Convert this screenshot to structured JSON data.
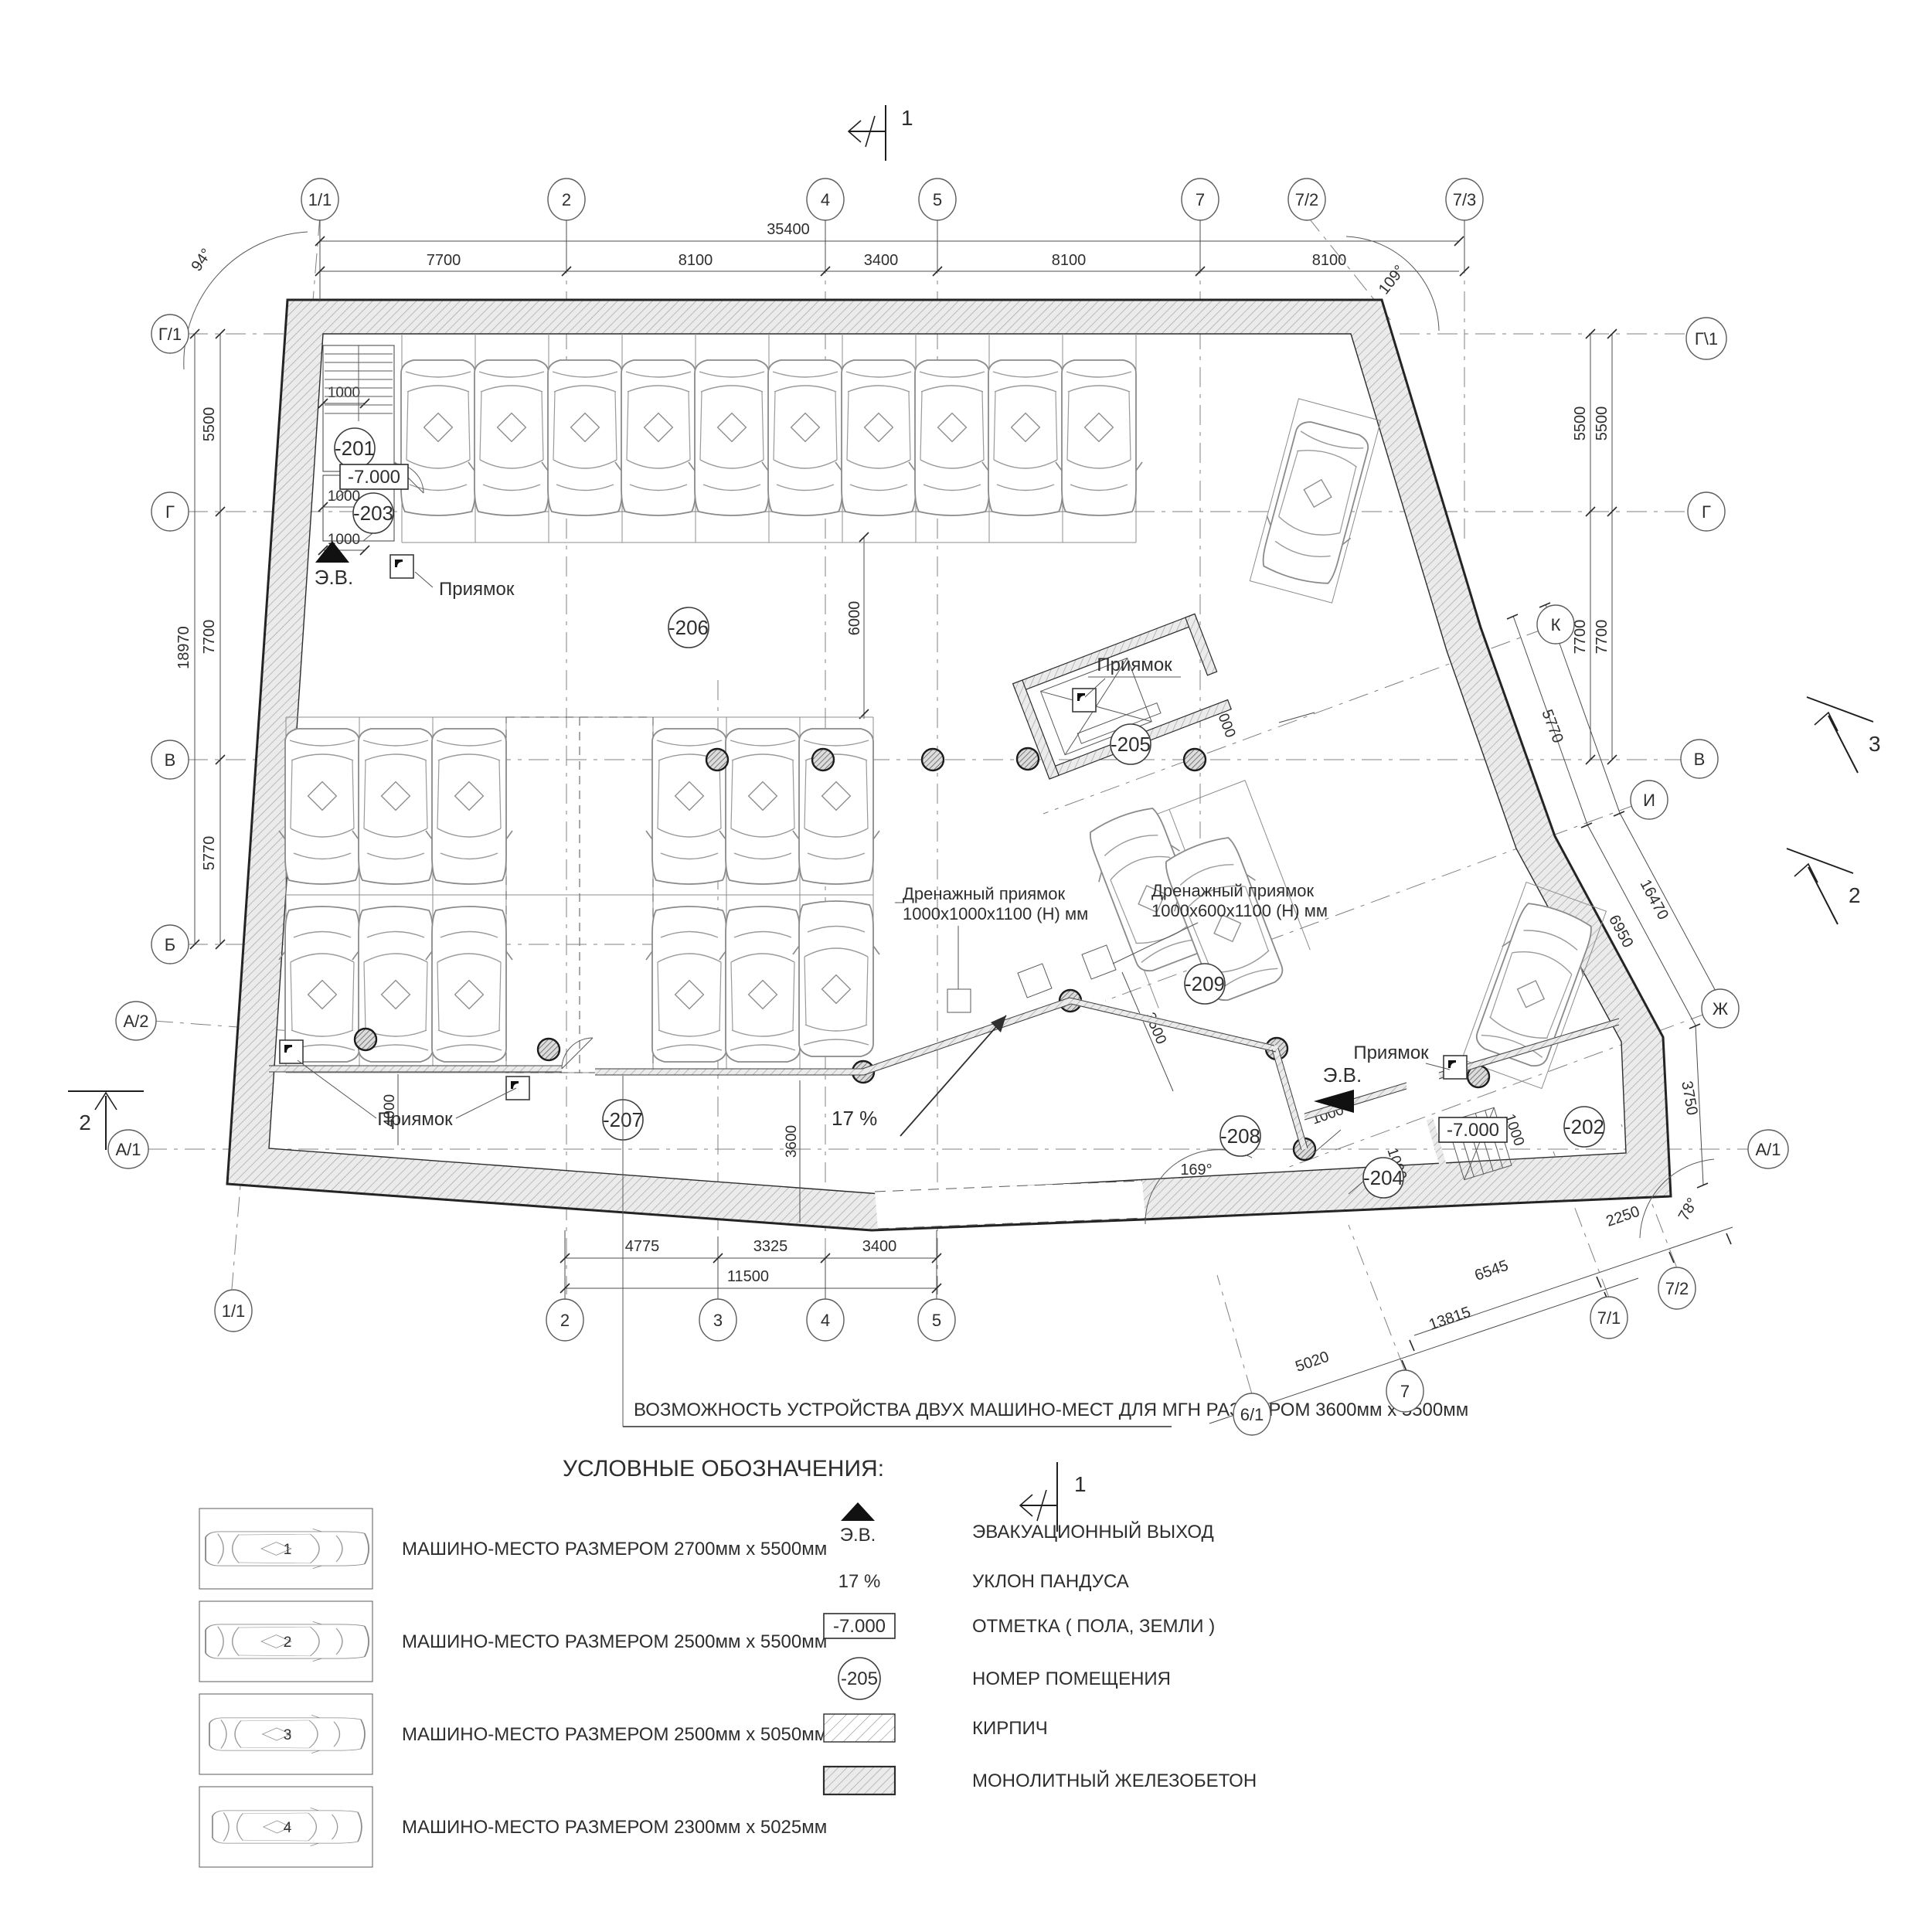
{
  "axes": {
    "top": [
      "1/1",
      "2",
      "4",
      "5",
      "7",
      "7/2",
      "7/3"
    ],
    "bottom": [
      "2",
      "3",
      "4",
      "5"
    ],
    "bottom_left": "1/1",
    "bottom_right": [
      "6/1",
      "7",
      "7/1",
      "7/2"
    ],
    "left": [
      "Г/1",
      "Г",
      "В",
      "Б",
      "А/2",
      "А/1"
    ],
    "right": [
      "Г\\1",
      "Г",
      "К",
      "В",
      "И",
      "Ж",
      "А/1"
    ]
  },
  "dims": {
    "top_total": "35400",
    "top": [
      "7700",
      "8100",
      "3400",
      "8100",
      "8100"
    ],
    "left_total": "18970",
    "left": [
      "5500",
      "7700",
      "5770"
    ],
    "right_v": [
      "5500",
      "5500",
      "7700",
      "7700"
    ],
    "right_diag": [
      "5770",
      "16470",
      "6950",
      "3750"
    ],
    "bottom": [
      "4775",
      "3325",
      "3400"
    ],
    "bottom_total": "11500",
    "bottom_right": [
      "5020",
      "13815",
      "6545",
      "2250"
    ],
    "misc": {
      "st1": "1000",
      "st2": "1000",
      "st3": "1000",
      "w4000": "4000",
      "h6000": "6000",
      "r3600": "3600",
      "r3500": "3500",
      "p1000": "1000",
      "m1": "1000",
      "m2": "1000",
      "m3": "1000"
    },
    "angles": {
      "a94": "94°",
      "a109": "109°",
      "a169": "169°",
      "a78": "78°"
    }
  },
  "rooms": {
    "201": "-201",
    "202": "-202",
    "203": "-203",
    "204": "-204",
    "205": "-205",
    "206": "-206",
    "207": "-207",
    "208": "-208",
    "209": "-209"
  },
  "labels": {
    "pit": "Приямок",
    "exit": "Э.В.",
    "level": "-7.000",
    "slope": "17 %",
    "drain": "Дренажный приямок",
    "drain1": "1000х1000х1100 (Н) мм",
    "drain2": "1000х600х1100 (Н) мм"
  },
  "sections": {
    "cut1": "1",
    "cut2": "2",
    "cut3": "3"
  },
  "note": "ВОЗМОЖНОСТЬ УСТРОЙСТВА ДВУХ МАШИНО-МЕСТ ДЛЯ МГН РАЗМЕРОМ 3600мм х 5500мм",
  "legend": {
    "title": "УСЛОВНЫЕ ОБОЗНАЧЕНИЯ:",
    "cars": [
      "МАШИНО-МЕСТО РАЗМЕРОМ 2700мм х 5500мм",
      "МАШИНО-МЕСТО РАЗМЕРОМ 2500мм х 5500мм",
      "МАШИНО-МЕСТО РАЗМЕРОМ 2500мм х 5050мм",
      "МАШИНО-МЕСТО РАЗМЕРОМ 2300мм х 5025мм"
    ],
    "marks": [
      "1",
      "2",
      "3",
      "4"
    ],
    "rows": [
      {
        "sym": "Э.В.",
        "label": "ЭВАКУАЦИОННЫЙ ВЫХОД"
      },
      {
        "sym": "17 %",
        "label": "УКЛОН ПАНДУСА"
      },
      {
        "sym": "-7.000",
        "label": "ОТМЕТКА ( ПОЛА, ЗЕМЛИ )"
      },
      {
        "sym": "-205",
        "label": "НОМЕР ПОМЕЩЕНИЯ"
      },
      {
        "sym": "",
        "label": "КИРПИЧ"
      },
      {
        "sym": "",
        "label": "МОНОЛИТНЫЙ ЖЕЛЕЗОБЕТОН"
      }
    ]
  }
}
